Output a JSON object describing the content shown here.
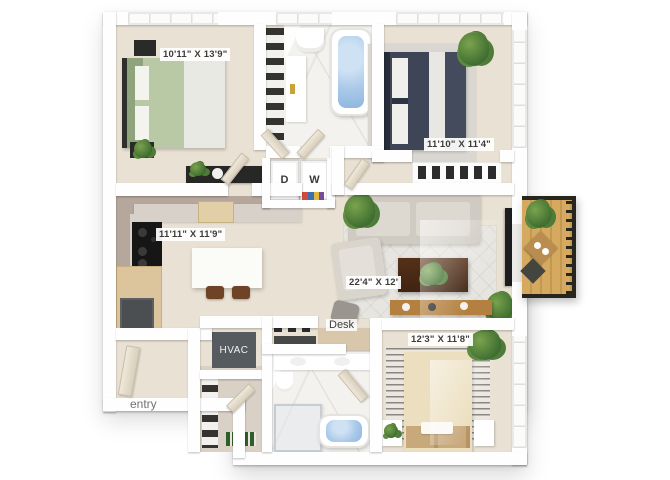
{
  "floorplan": {
    "rooms": {
      "bedroom_top_left": {
        "dimensions": "10'11\" X 13'9\""
      },
      "bedroom_top_right": {
        "dimensions": "11'10\" X 11'4\""
      },
      "kitchen": {
        "dimensions": "11'11\" X 11'9\""
      },
      "living_dining": {
        "dimensions": "22'4\" X 12'"
      },
      "bedroom_bottom_right": {
        "dimensions": "12'3\" X 11'8\""
      }
    },
    "labels": {
      "dryer": "D",
      "washer": "W",
      "hvac": "HVAC",
      "desk": "Desk",
      "entry": "entry"
    },
    "colors": {
      "floor": "#e9e1d3",
      "marble": "#f4f2ee",
      "wall": "#fefefe",
      "bed_green": "#b9c8a5",
      "bed_navy": "#3d4556",
      "bed_cream": "#ecdfbf",
      "balcony_deck": "#d5aa60",
      "hvac_unit": "#565b60",
      "bath_water": "#a9c9e9",
      "label_text": "#3e3c39"
    }
  }
}
